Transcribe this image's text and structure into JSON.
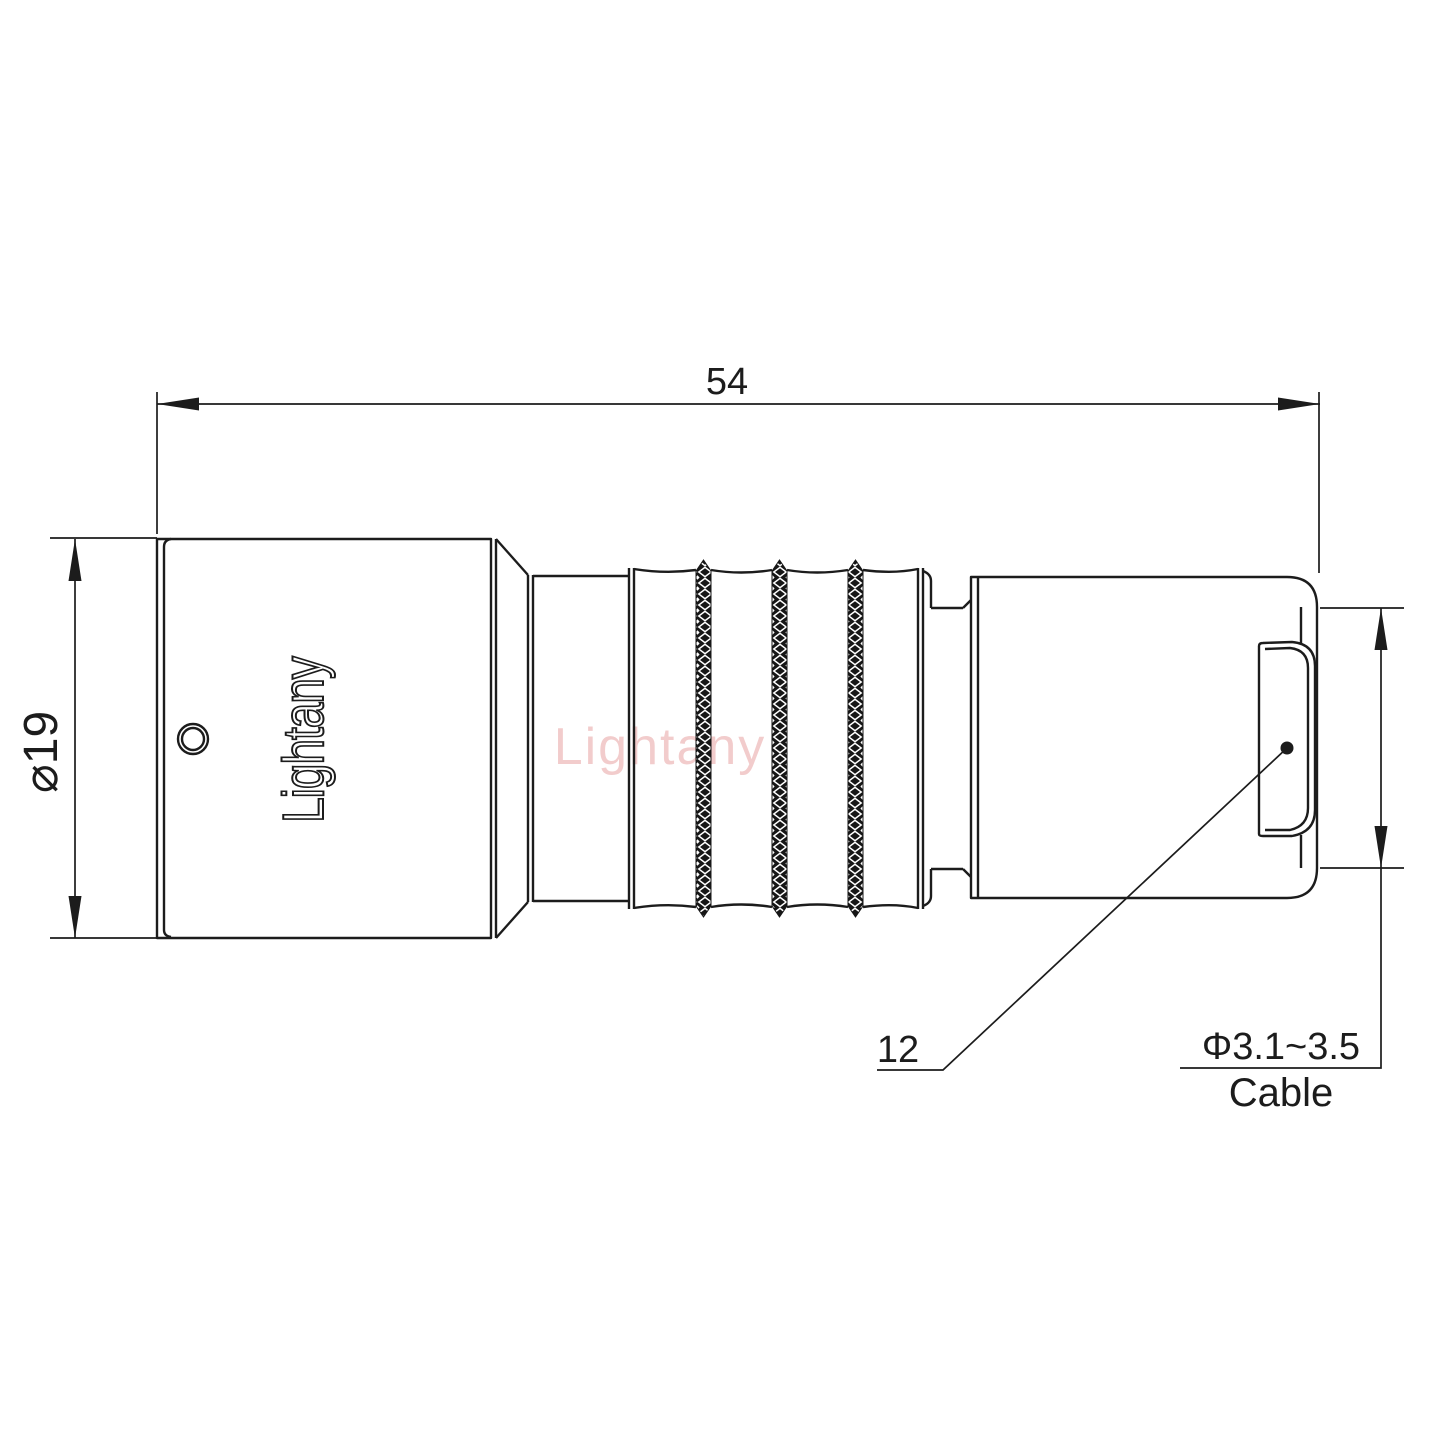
{
  "page": {
    "background": "#ffffff"
  },
  "drawing": {
    "type": "connector-technical-drawing",
    "dimensions": {
      "overall_length": "54",
      "body_diameter": "⌀19",
      "backshell_ref": "12",
      "cable_range": "Φ3.1~3.5",
      "cable_label": "Cable"
    },
    "branding": {
      "engraving": "Lightany",
      "watermark": "Lightany"
    },
    "colors": {
      "line": "#1c1c1c",
      "watermark": "#d96c6c"
    }
  }
}
